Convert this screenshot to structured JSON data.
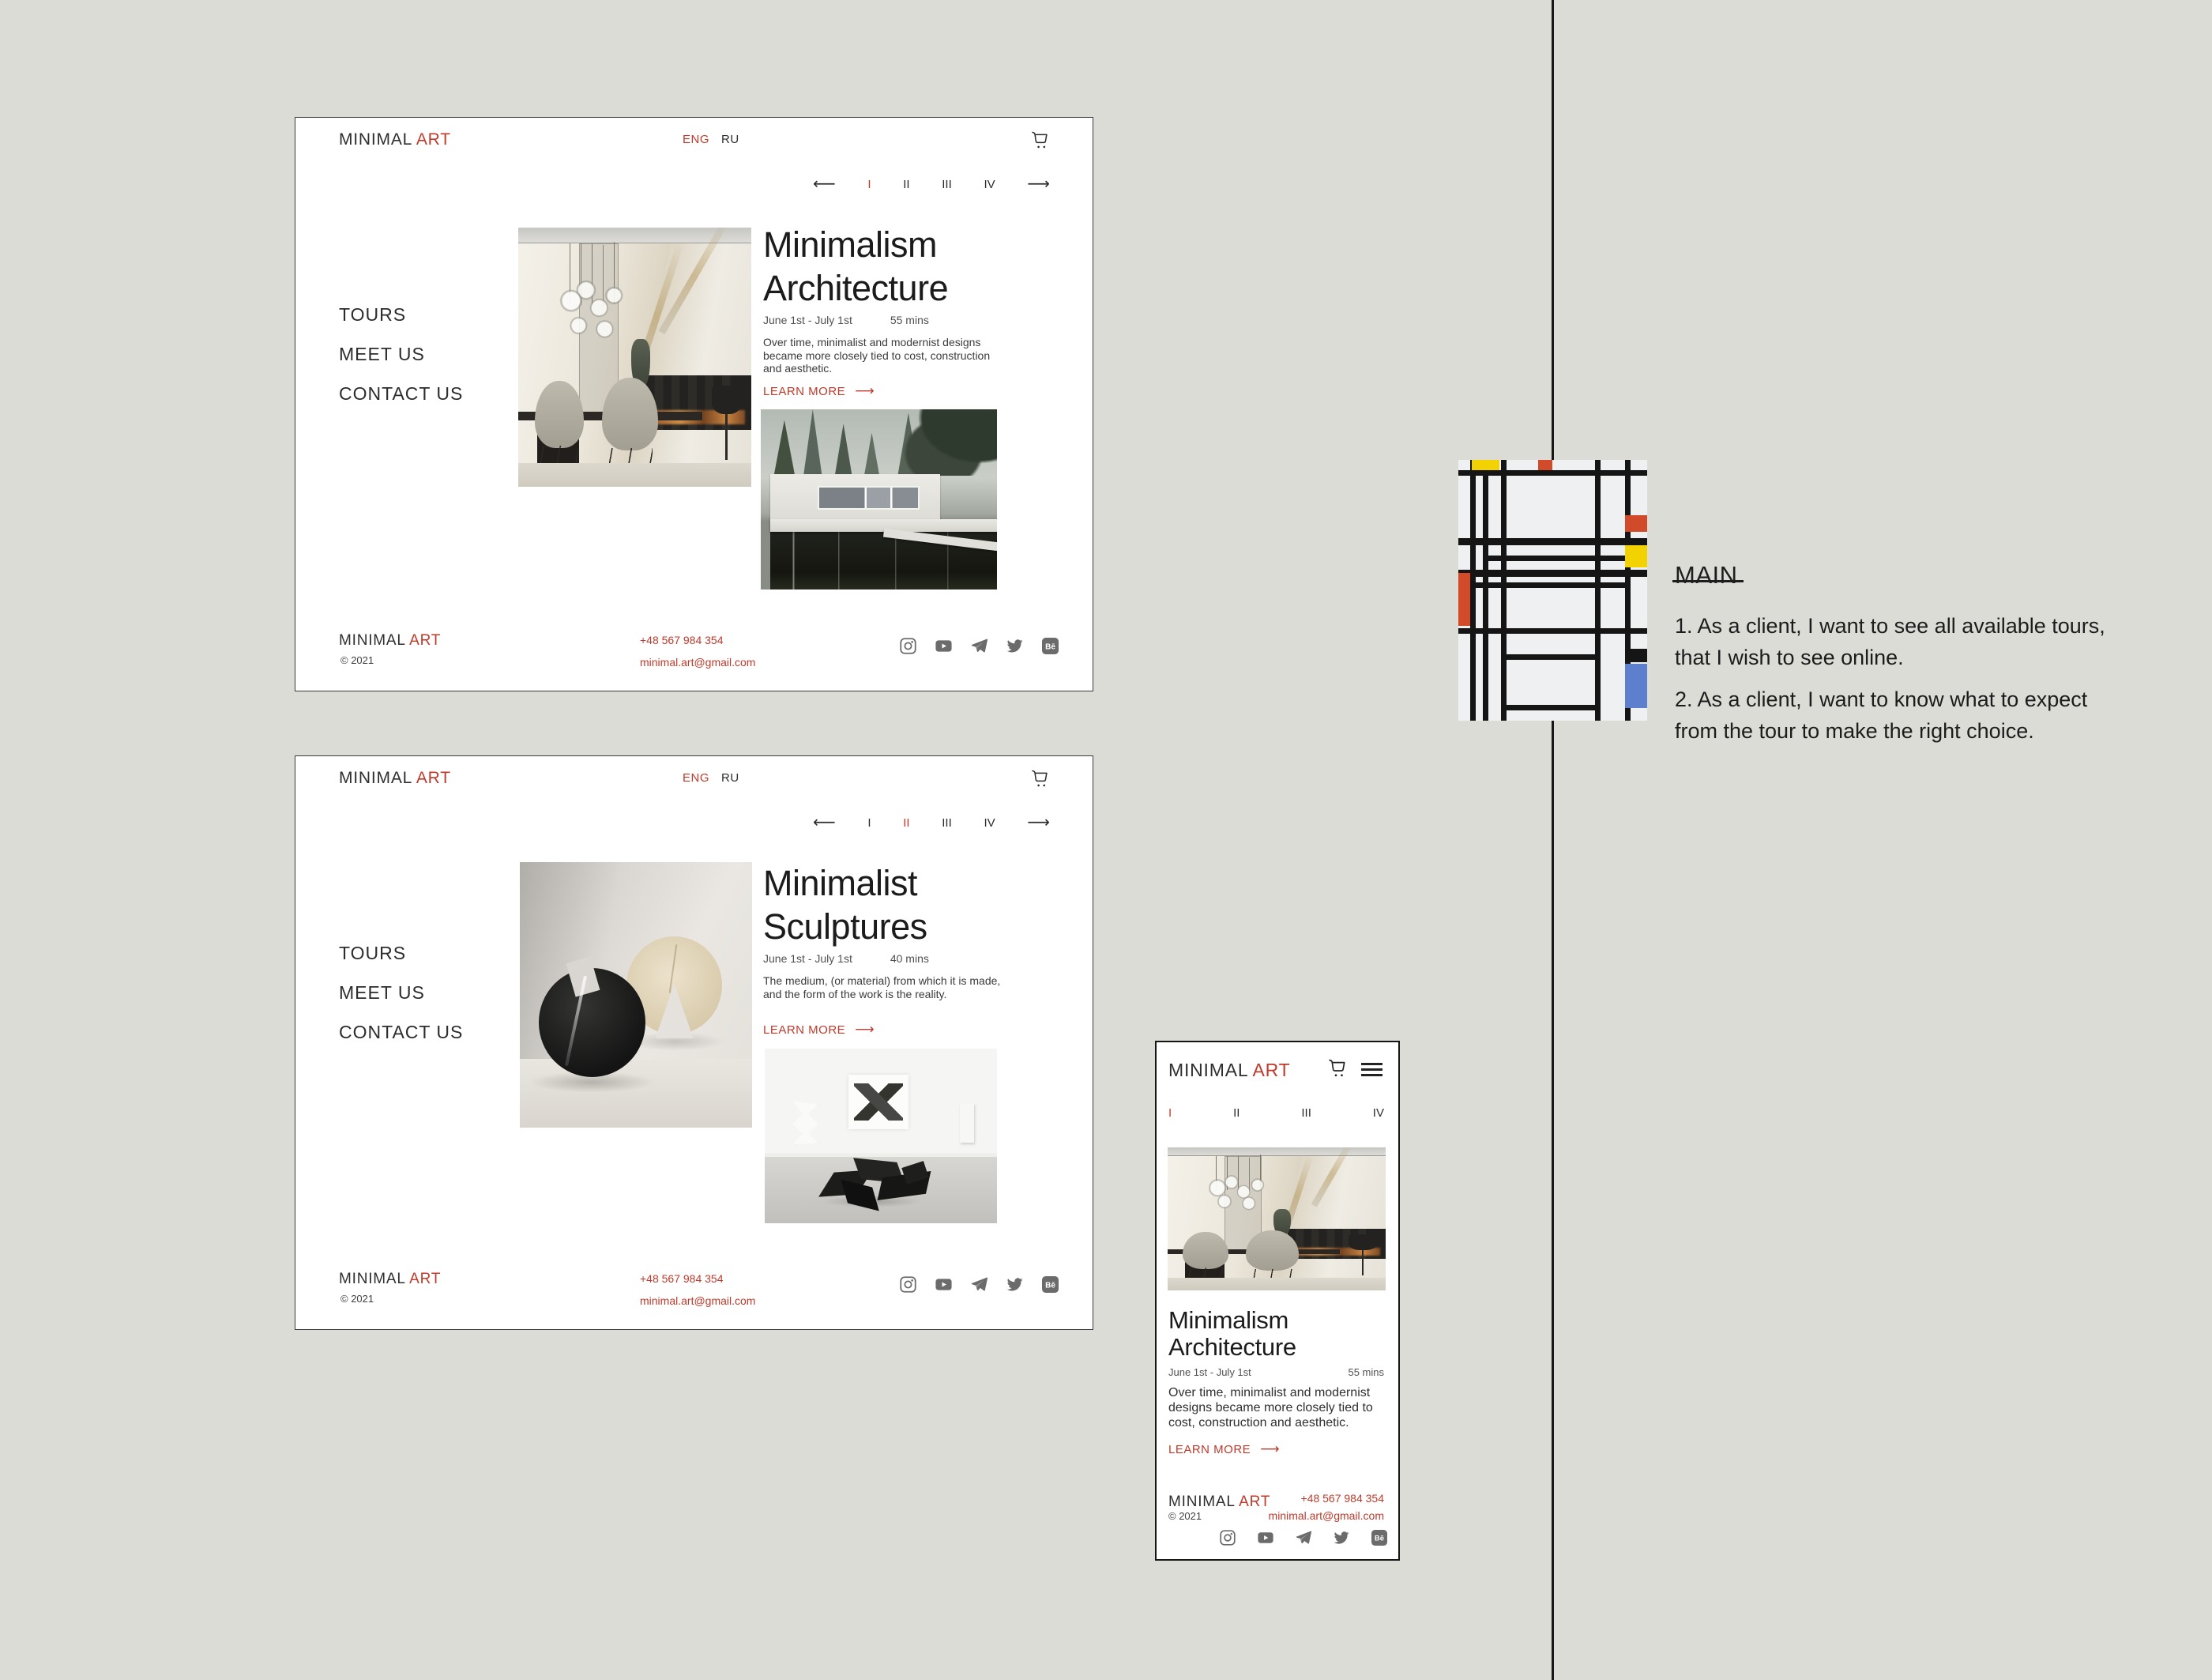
{
  "canvas": {
    "background": "#dcdcd7",
    "accent_red": "#bf3a2b",
    "divider_color": "#161616"
  },
  "shared": {
    "logo": {
      "primary": "MINIMAL",
      "secondary": "ART"
    },
    "lang": {
      "eng": "ENG",
      "ru": "RU"
    },
    "arrows": {
      "left": "⟵",
      "right": "⟶"
    },
    "pagination": [
      "I",
      "II",
      "III",
      "IV"
    ],
    "nav": [
      "TOURS",
      "MEET US",
      "CONTACT US"
    ],
    "learn_more_label": "LEARN MORE",
    "footer": {
      "copyright": "© 2021",
      "phone": "+48 567 984 354",
      "email": "minimal.art@gmail.com",
      "social_icons": [
        "instagram",
        "youtube",
        "telegram",
        "twitter",
        "behance"
      ]
    }
  },
  "desktop_page_1": {
    "active_page": "I",
    "title_line1": "Minimalism",
    "title_line2": "Architecture",
    "date_range": "June 1st - July 1st",
    "duration": "55 mins",
    "description": "Over time, minimalist and modernist designs became more closely tied to cost, construction and aesthetic."
  },
  "desktop_page_2": {
    "active_page": "II",
    "title_line1": "Minimalist",
    "title_line2": "Sculptures",
    "date_range": "June 1st - July 1st",
    "duration": "40 mins",
    "description": "The medium, (or material) from which it is made, and the form of the work is the reality."
  },
  "mobile_page": {
    "active_page": "I",
    "title_line1": "Minimalism",
    "title_line2": "Architecture",
    "date_range": "June 1st - July 1st",
    "duration": "55 mins",
    "description": "Over time, minimalist and modernist designs became more closely tied to cost, construction and aesthetic."
  },
  "annotation": {
    "heading": "MAIN",
    "stories": [
      "1. As a client, I want to see all available tours, that I wish to see online.",
      "2. As a client, I want to know what to expect from the tour to make the right choice."
    ]
  },
  "painting": {
    "name": "mondrian-composition",
    "palette": {
      "red": "#d14a2a",
      "yellow": "#f2d200",
      "blue": "#5d7fce",
      "black": "#151515",
      "background": "#eef0f2"
    }
  }
}
